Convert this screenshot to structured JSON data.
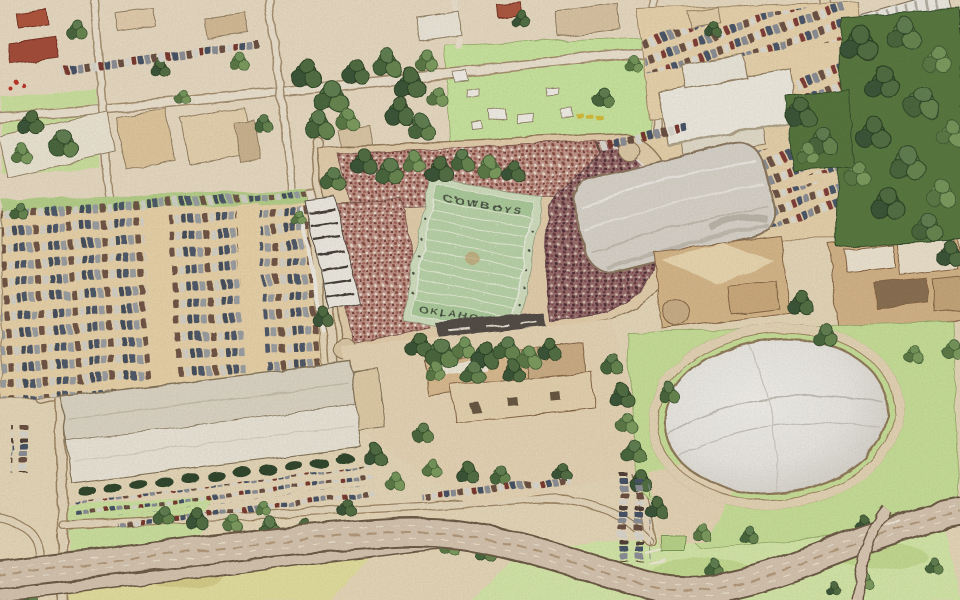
{
  "scene": {
    "title": "Colored-pencil style oblique aerial illustration of a college football stadium complex with attached arena, white practice dome, indoor facility, parking lots, campus streets and a curving boulevard",
    "style": "sketch / colored pencil aerial rendering"
  },
  "stadium": {
    "endzone_north_text": "COWBOYS",
    "endzone_south_text": "OKLAHOMA"
  },
  "palette": {
    "paper_tan": "#eadcbe",
    "field_green": "#bdd8ae",
    "endzone_green": "#aecfa0",
    "crowd_light": "#c59b8e",
    "crowd_dark": "#9b7270",
    "dome_white": "#efeeea",
    "lawn_green": "#cde69f",
    "tree_green": "#4a6540",
    "road_tan": "#d9c9b5",
    "building_tan": "#dabb8e",
    "roof_white": "#f2efe6"
  }
}
